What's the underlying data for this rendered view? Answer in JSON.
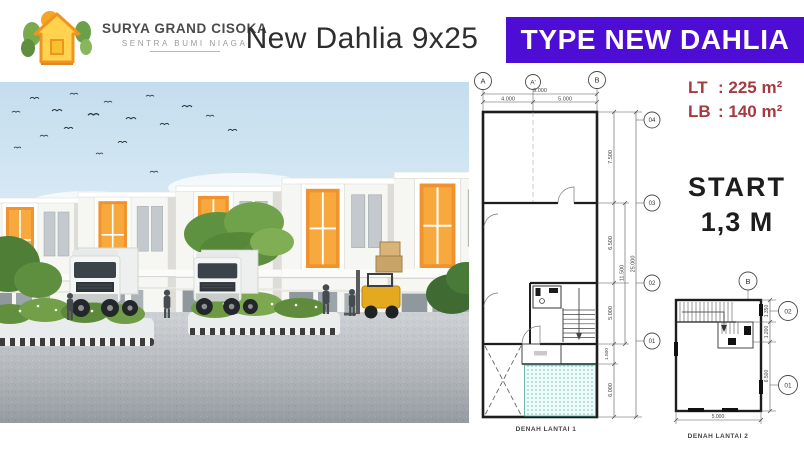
{
  "brand": {
    "name": "SURYA GRAND CISOKA",
    "tagline": "SENTRA BUMI NIAGA"
  },
  "header": {
    "title": "New Dahlia 9x25",
    "type_banner": "TYPE NEW DAHLIA"
  },
  "specs": {
    "rows": [
      {
        "label": "LT",
        "value": ": 225 m²"
      },
      {
        "label": "LB",
        "value": ": 140 m²"
      }
    ]
  },
  "price": {
    "line1": "START",
    "line2": "1,3 M"
  },
  "floorplan1": {
    "caption": "DENAH LANTAI 1",
    "grid_cols": [
      "A",
      "A'",
      "B"
    ],
    "grid_rows": [
      "04",
      "03",
      "02",
      "01"
    ],
    "dims": {
      "w_total": "9.000",
      "w_left": "4.000",
      "w_right": "5.000",
      "d1": "7.500",
      "d2": "6.500",
      "d3": "5.000",
      "d4": "1.500",
      "d5": "6.000",
      "mid": "11.500",
      "total": "25.000"
    }
  },
  "floorplan2": {
    "caption": "DENAH LANTAI 2",
    "grid_col": "B",
    "grid_rows": [
      "02",
      "01"
    ],
    "dims": {
      "d1": "1.350",
      "d2": "1.200",
      "d3": "6.500",
      "width": "5.000"
    }
  },
  "colors": {
    "banner_bg": "#4e0dd4",
    "banner_text": "#ffffff",
    "specs_text": "#a53a40",
    "price_text": "#1d1d1d",
    "accent_orange": "#f0922d",
    "patio_teal": "#63c2b8"
  }
}
